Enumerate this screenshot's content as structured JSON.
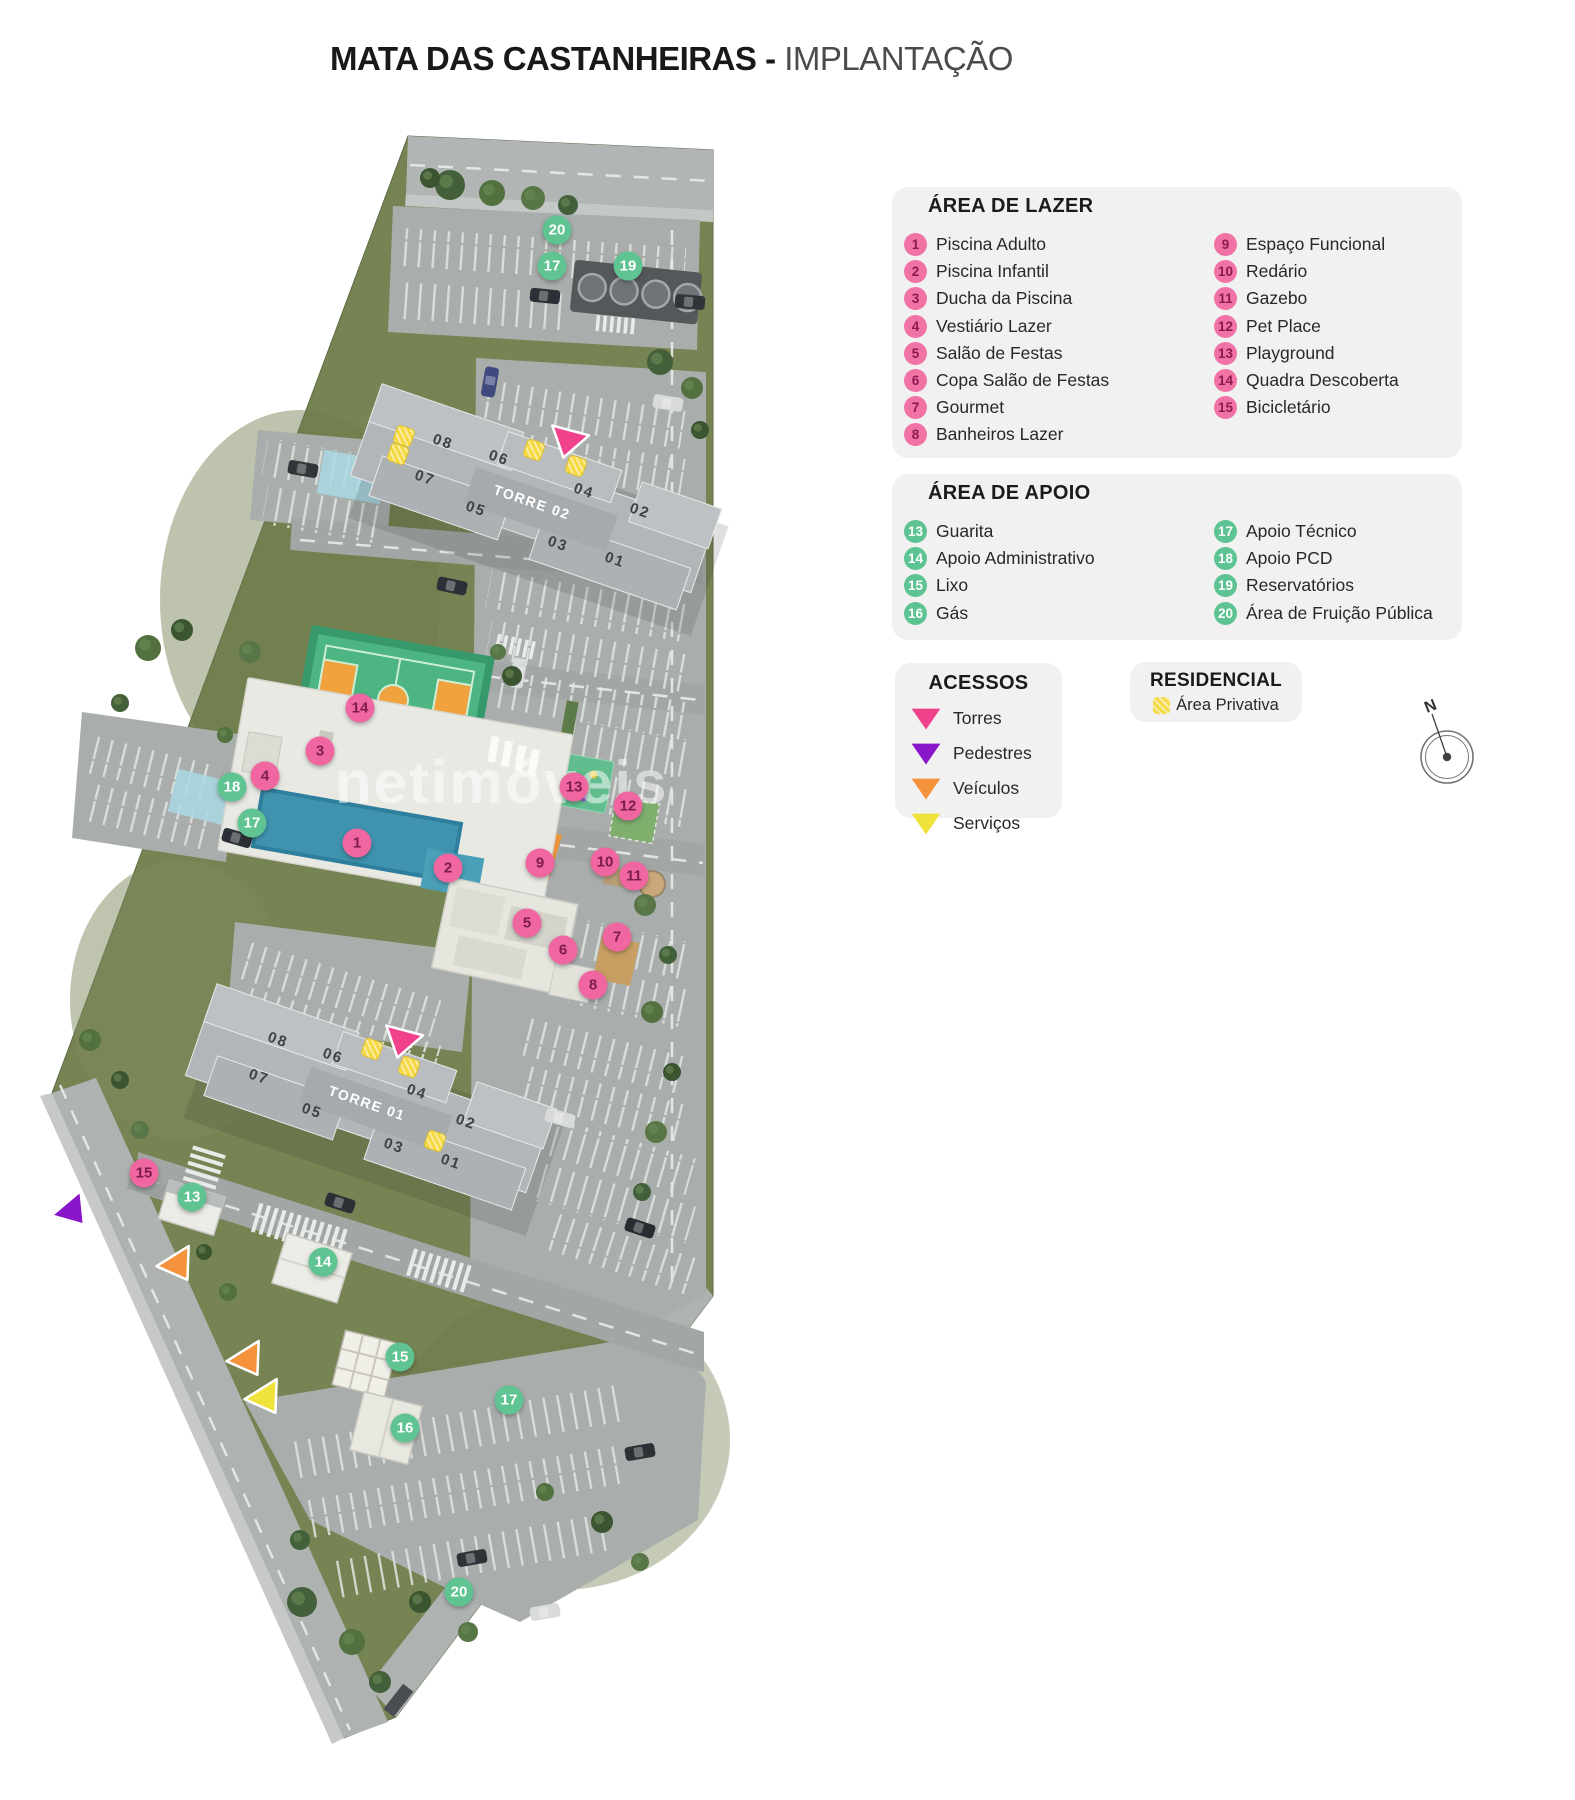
{
  "title": {
    "main": "MATA DAS CASTANHEIRAS",
    "sep": " - ",
    "sub": "IMPLANTAÇÃO"
  },
  "watermark": "netimóveis",
  "compass_label": "N",
  "legend_lazer": {
    "title": "ÁREA DE LAZER",
    "items": [
      {
        "n": "1",
        "label": "Piscina Adulto"
      },
      {
        "n": "2",
        "label": "Piscina Infantil"
      },
      {
        "n": "3",
        "label": "Ducha da Piscina"
      },
      {
        "n": "4",
        "label": "Vestiário Lazer"
      },
      {
        "n": "5",
        "label": "Salão de Festas"
      },
      {
        "n": "6",
        "label": "Copa Salão de Festas"
      },
      {
        "n": "7",
        "label": "Gourmet"
      },
      {
        "n": "8",
        "label": "Banheiros Lazer"
      },
      {
        "n": "9",
        "label": "Espaço Funcional"
      },
      {
        "n": "10",
        "label": "Redário"
      },
      {
        "n": "11",
        "label": "Gazebo"
      },
      {
        "n": "12",
        "label": "Pet Place"
      },
      {
        "n": "13",
        "label": "Playground"
      },
      {
        "n": "14",
        "label": "Quadra Descoberta"
      },
      {
        "n": "15",
        "label": "Bicicletário"
      }
    ]
  },
  "legend_apoio": {
    "title": "ÁREA DE APOIO",
    "items": [
      {
        "n": "13",
        "label": "Guarita"
      },
      {
        "n": "14",
        "label": "Apoio Administrativo"
      },
      {
        "n": "15",
        "label": "Lixo"
      },
      {
        "n": "16",
        "label": "Gás"
      },
      {
        "n": "17",
        "label": "Apoio Técnico"
      },
      {
        "n": "18",
        "label": "Apoio PCD"
      },
      {
        "n": "19",
        "label": "Reservatórios"
      },
      {
        "n": "20",
        "label": "Área de Fruição Pública"
      }
    ]
  },
  "legend_acessos": {
    "title": "ACESSOS",
    "items": [
      {
        "label": "Torres",
        "color": "#f0418c"
      },
      {
        "label": "Pedestres",
        "color": "#8a16c9"
      },
      {
        "label": "Veículos",
        "color": "#f5923c"
      },
      {
        "label": "Serviços",
        "color": "#efe23b"
      }
    ]
  },
  "legend_residencial": {
    "title": "RESIDENCIAL",
    "label": "Área Privativa",
    "color": "#f4d94a"
  },
  "map": {
    "markers": [
      {
        "kind": "lazer",
        "n": "1",
        "x": 357,
        "y": 843
      },
      {
        "kind": "lazer",
        "n": "2",
        "x": 448,
        "y": 868
      },
      {
        "kind": "lazer",
        "n": "3",
        "x": 320,
        "y": 751
      },
      {
        "kind": "lazer",
        "n": "4",
        "x": 265,
        "y": 776
      },
      {
        "kind": "lazer",
        "n": "5",
        "x": 527,
        "y": 923
      },
      {
        "kind": "lazer",
        "n": "6",
        "x": 563,
        "y": 950
      },
      {
        "kind": "lazer",
        "n": "7",
        "x": 617,
        "y": 937
      },
      {
        "kind": "lazer",
        "n": "8",
        "x": 593,
        "y": 985
      },
      {
        "kind": "lazer",
        "n": "9",
        "x": 540,
        "y": 863
      },
      {
        "kind": "lazer",
        "n": "10",
        "x": 605,
        "y": 862
      },
      {
        "kind": "lazer",
        "n": "11",
        "x": 634,
        "y": 876
      },
      {
        "kind": "lazer",
        "n": "12",
        "x": 628,
        "y": 806
      },
      {
        "kind": "lazer",
        "n": "13",
        "x": 574,
        "y": 787
      },
      {
        "kind": "lazer",
        "n": "14",
        "x": 360,
        "y": 708
      },
      {
        "kind": "lazer",
        "n": "15",
        "x": 144,
        "y": 1173
      },
      {
        "kind": "apoio",
        "n": "20",
        "x": 557,
        "y": 230
      },
      {
        "kind": "apoio",
        "n": "17",
        "x": 552,
        "y": 266
      },
      {
        "kind": "apoio",
        "n": "19",
        "x": 628,
        "y": 266
      },
      {
        "kind": "apoio",
        "n": "18",
        "x": 232,
        "y": 787
      },
      {
        "kind": "apoio",
        "n": "17",
        "x": 252,
        "y": 823
      },
      {
        "kind": "apoio",
        "n": "13",
        "x": 192,
        "y": 1197
      },
      {
        "kind": "apoio",
        "n": "14",
        "x": 323,
        "y": 1262
      },
      {
        "kind": "apoio",
        "n": "15",
        "x": 400,
        "y": 1357
      },
      {
        "kind": "apoio",
        "n": "16",
        "x": 405,
        "y": 1428
      },
      {
        "kind": "apoio",
        "n": "17",
        "x": 509,
        "y": 1400
      },
      {
        "kind": "apoio",
        "n": "20",
        "x": 459,
        "y": 1592
      }
    ],
    "towers": [
      {
        "name": "TORRE 02",
        "x": 532,
        "y": 502,
        "rot": 19,
        "units": [
          {
            "n": "08",
            "x": 443,
            "y": 442
          },
          {
            "n": "06",
            "x": 499,
            "y": 458
          },
          {
            "n": "04",
            "x": 584,
            "y": 491
          },
          {
            "n": "02",
            "x": 640,
            "y": 511
          },
          {
            "n": "07",
            "x": 425,
            "y": 478
          },
          {
            "n": "05",
            "x": 476,
            "y": 509
          },
          {
            "n": "03",
            "x": 558,
            "y": 544
          },
          {
            "n": "01",
            "x": 615,
            "y": 560
          }
        ]
      },
      {
        "name": "TORRE 01",
        "x": 367,
        "y": 1103,
        "rot": 19,
        "units": [
          {
            "n": "08",
            "x": 278,
            "y": 1040
          },
          {
            "n": "06",
            "x": 333,
            "y": 1056
          },
          {
            "n": "04",
            "x": 417,
            "y": 1092
          },
          {
            "n": "02",
            "x": 466,
            "y": 1122
          },
          {
            "n": "07",
            "x": 259,
            "y": 1077
          },
          {
            "n": "05",
            "x": 312,
            "y": 1111
          },
          {
            "n": "03",
            "x": 394,
            "y": 1146
          },
          {
            "n": "01",
            "x": 451,
            "y": 1162
          }
        ]
      }
    ],
    "access_points": [
      {
        "type": "torres",
        "color": "#f0418c",
        "x": 567,
        "y": 444,
        "rot": 15
      },
      {
        "type": "torres",
        "color": "#f0418c",
        "x": 401,
        "y": 1044,
        "rot": 15
      },
      {
        "type": "pedestres",
        "color": "#8a16c9",
        "x": 75,
        "y": 1214,
        "rot": -40
      },
      {
        "type": "veiculos",
        "color": "#f5923c",
        "x": 180,
        "y": 1268,
        "rot": -32
      },
      {
        "type": "veiculos",
        "color": "#f5923c",
        "x": 250,
        "y": 1363,
        "rot": -32
      },
      {
        "type": "servicos",
        "color": "#efe23b",
        "x": 268,
        "y": 1401,
        "rot": -32
      }
    ],
    "private_squares": [
      {
        "x": 404,
        "y": 436
      },
      {
        "x": 398,
        "y": 454
      },
      {
        "x": 534,
        "y": 450
      },
      {
        "x": 576,
        "y": 466
      },
      {
        "x": 372,
        "y": 1049
      },
      {
        "x": 409,
        "y": 1067
      },
      {
        "x": 435,
        "y": 1141
      }
    ]
  }
}
